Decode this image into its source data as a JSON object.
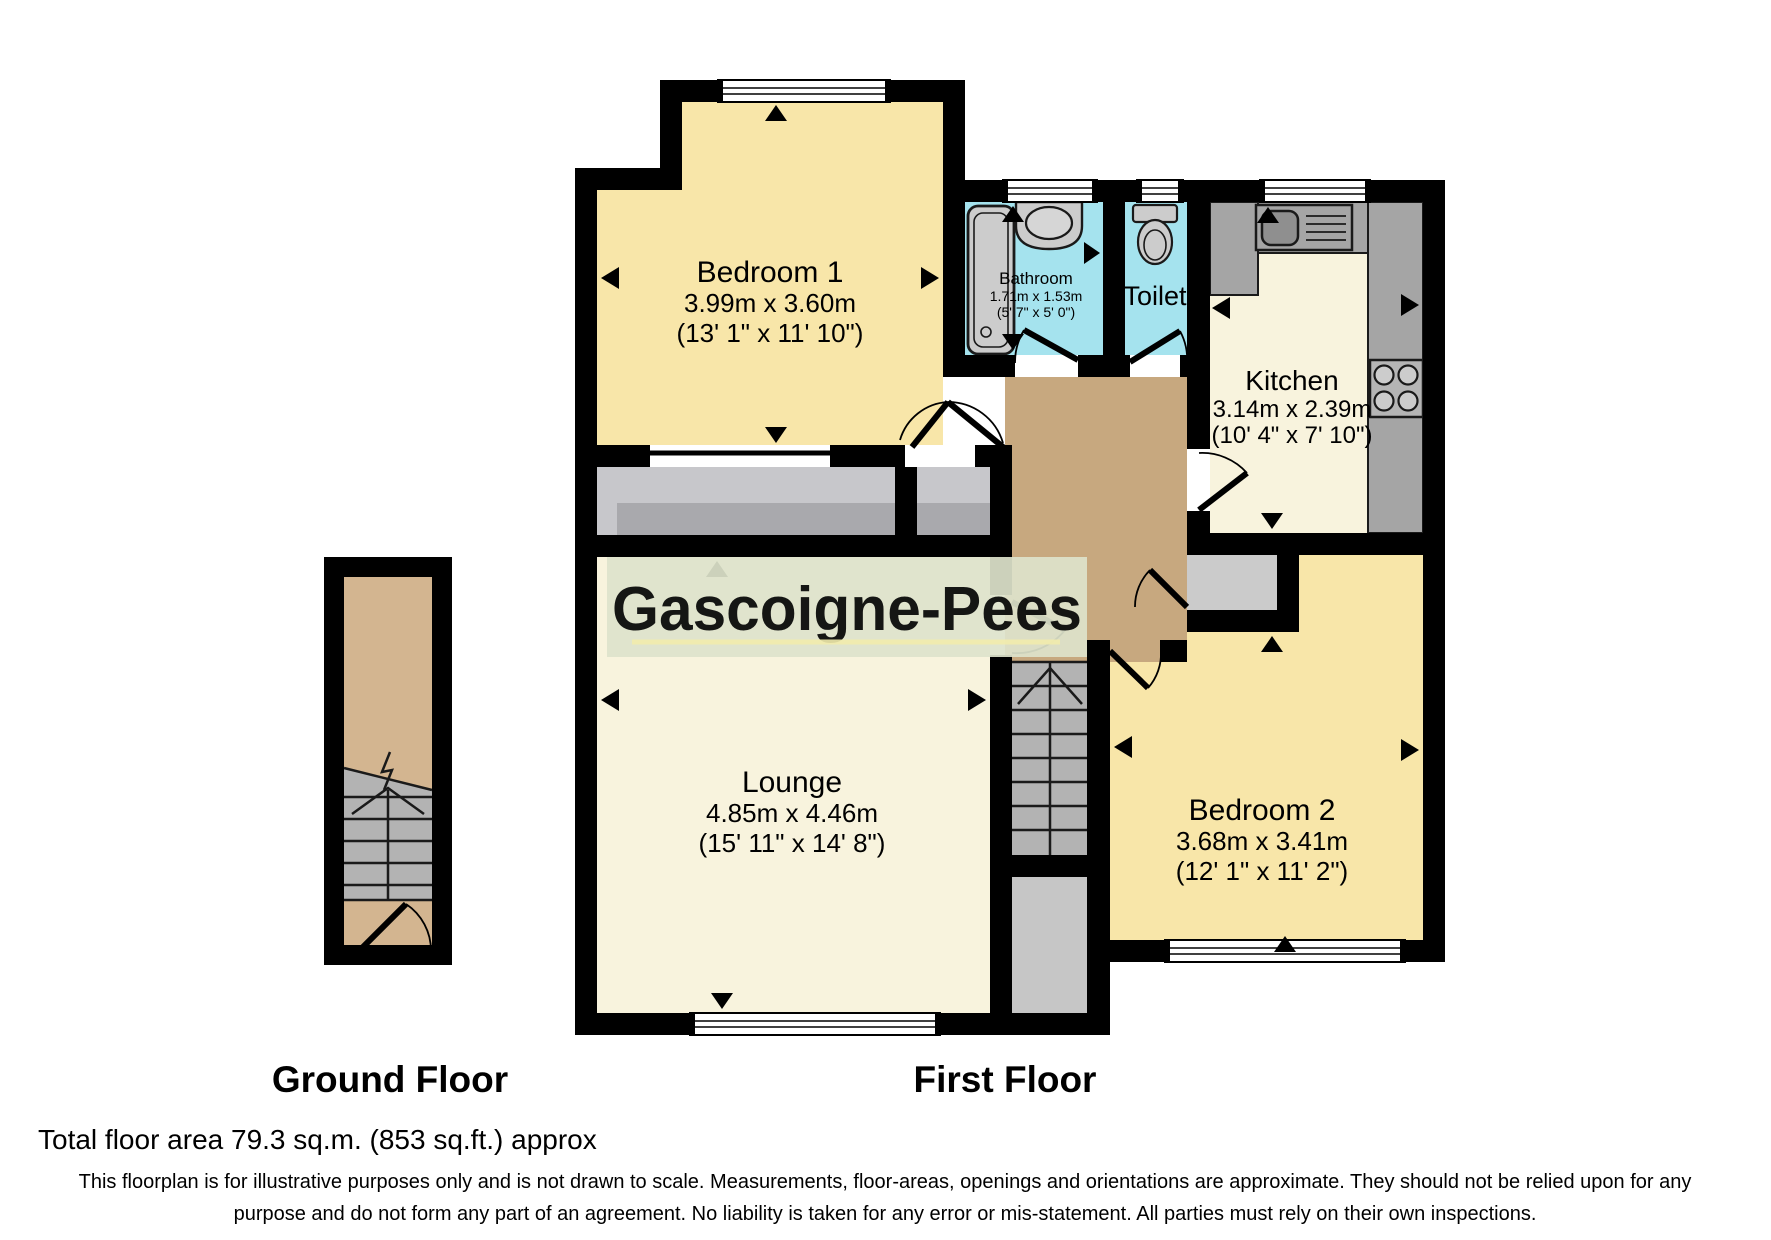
{
  "watermark": {
    "text": "Gascoigne-Pees"
  },
  "floors": {
    "ground": {
      "label": "Ground Floor"
    },
    "first": {
      "label": "First Floor"
    }
  },
  "rooms": {
    "bedroom1": {
      "name": "Bedroom 1",
      "metric": "3.99m x 3.60m",
      "imperial": "(13' 1\" x 11' 10\")"
    },
    "bathroom": {
      "name": "Bathroom",
      "metric": "1.71m x 1.53m",
      "imperial": "(5' 7\" x 5' 0\")"
    },
    "toilet": {
      "name": "Toilet"
    },
    "kitchen": {
      "name": "Kitchen",
      "metric": "3.14m x 2.39m",
      "imperial": "(10' 4\" x 7' 10\")"
    },
    "lounge": {
      "name": "Lounge",
      "metric": "4.85m x 4.46m",
      "imperial": "(15' 11\" x 14' 8\")"
    },
    "bedroom2": {
      "name": "Bedroom 2",
      "metric": "3.68m x 3.41m",
      "imperial": "(12' 1\" x 11' 2\")"
    }
  },
  "footer": {
    "total_area": "Total floor area 79.3 sq.m. (853 sq.ft.) approx",
    "disclaimer_line1": "This floorplan is for illustrative purposes only and is not drawn to scale. Measurements, floor-areas, openings and orientations are approximate. They should not be relied upon for any",
    "disclaimer_line2": "purpose and do not form any part of an agreement. No liability is taken for any error or mis-statement. All parties must rely on their own inspections."
  },
  "colors": {
    "wall": "#000000",
    "bedroom_fill": "#f8e6a9",
    "cream_fill": "#f8f3dd",
    "hall_fill": "#c7a87f",
    "ground_hall_fill": "#d3b590",
    "bath_fill": "#a5e3ee",
    "stair_fill": "#b3b3b3",
    "entry_fill": "#c6c6c6",
    "balcony_light": "#c7c7cb",
    "balcony_dark": "#a9a9ad",
    "counter_fill": "#a5a5a5",
    "fixture_fill": "#cccccc",
    "cupboard_fill": "#cbcbcb",
    "watermark_band": "#dde3cb",
    "watermark_text": "#f2ecad"
  }
}
